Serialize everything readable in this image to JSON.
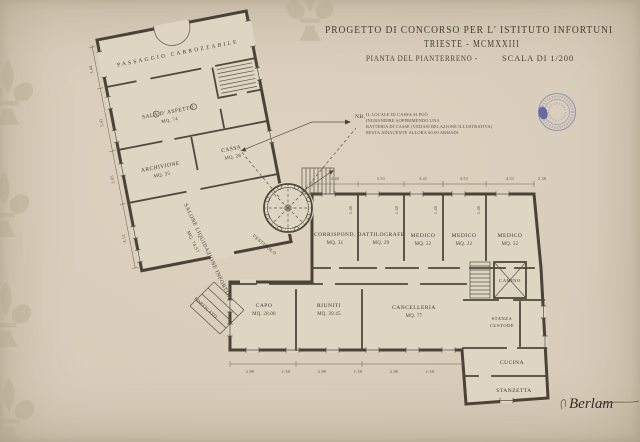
{
  "colors": {
    "paper": "#d7ccb8",
    "building_fill": "#ded5c3",
    "ink": "#4a4336",
    "dim_ink": "#6b6353",
    "stamp_blue": "#3c4da2",
    "watermark": "#b3a88f"
  },
  "title": {
    "line1": "PROGETTO DI CONCORSO PER L' ISTITUTO INFORTUNI",
    "line2": "TRIESTE - MCMXXIII",
    "line3a": "PIANTA DEL PIANTERRENO -",
    "line3b": "SCALA DI 1/200"
  },
  "note": {
    "label": "NB.",
    "line1": "IL LOCALE DI CASSA SI PUÒ",
    "line2": "INGRANDIRE SOPPRIMENDO UNA",
    "line3": "BATTERIA DI CASSE (VEDASI RELAZIONE ILLUSTRATIVA)",
    "line4": "RESTA ADIACENTE ALLORA 60.00 ARMADI"
  },
  "rooms": {
    "passaggio": {
      "name": "PASSAGGIO CARROZZABILE"
    },
    "sala_aspetto": {
      "name": "SALA D' ASPETTO",
      "area": "MQ. 74"
    },
    "archivione": {
      "name": "ARCHIVIONE",
      "area": "MQ. 35"
    },
    "cassa": {
      "name": "CASSA",
      "area": "MQ. 28"
    },
    "salone": {
      "name": "SALONE LIQUIDAZIONE INFORTUNI",
      "area": "MQ. 74.57"
    },
    "corrispond": {
      "name": "CORRISPOND.",
      "area": "MQ. 31"
    },
    "dattilografe": {
      "name": "DATTILOGRAFE",
      "area": "MQ. 29"
    },
    "medico": {
      "name": "MEDICO",
      "area": "MQ. 22"
    },
    "capo": {
      "name": "CAPO",
      "area": "MQ. 28.00"
    },
    "riuniti": {
      "name": "RIUNITI",
      "area": "MQ. 39.45"
    },
    "cancelleria": {
      "name": "CANCELLERIA",
      "area": "MQ. 77"
    },
    "stanza_custode": {
      "line1": "STANZA",
      "line2": "CUSTODE"
    },
    "camino": {
      "name": "CAMINO"
    },
    "cucina": {
      "name": "CUCINA"
    },
    "stanzetta": {
      "name": "STANZETTA"
    },
    "vestibolo": {
      "name": "VESTIBOLO"
    },
    "porticato": {
      "name": "PORTICATO"
    }
  },
  "dimensions": {
    "top": [
      "3.40",
      "3.51",
      "3.41",
      "4.51",
      "4.51",
      "2.38"
    ],
    "bottom": [
      "2.80",
      "1.50",
      "2.80",
      "1.50",
      "2.80",
      "1.50"
    ],
    "left": [
      "3.44",
      "5.41",
      "3.05",
      "4.12"
    ],
    "windows": [
      "1.40",
      "1.40",
      "1.40",
      "1.40"
    ]
  },
  "signature": {
    "name": "Berlam"
  }
}
